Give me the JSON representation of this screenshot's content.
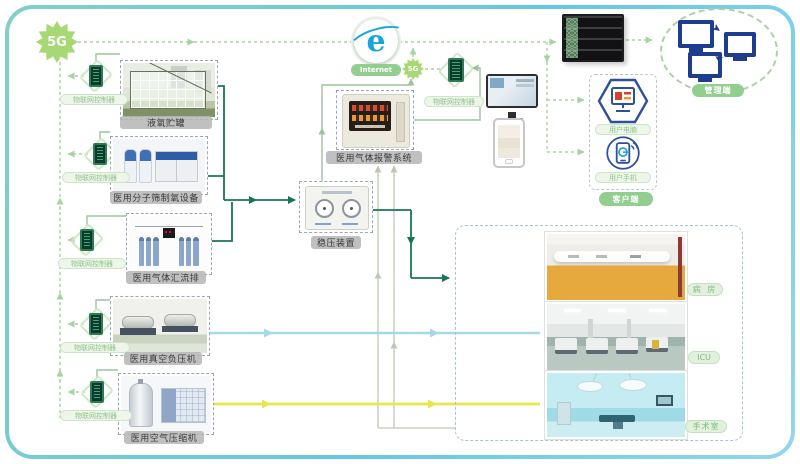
{
  "top": {
    "g5_main": "5G",
    "internet_label": "Internet",
    "g5_small": "5G",
    "gateway_label": "物联网控制器",
    "cloud_label": "管理端"
  },
  "client": {
    "pc_label": "用户电脑",
    "phone_label": "用户手机",
    "box_label": "客户端"
  },
  "center": {
    "alarm_label": "医用气体报警系统",
    "stabilizer_label": "稳压装置"
  },
  "devices": [
    {
      "controller": "物联网控制器",
      "name": "液氧贮罐"
    },
    {
      "controller": "物联网控制器",
      "name": "医用分子筛制氧设备"
    },
    {
      "controller": "物联网控制器",
      "name": "医用气体汇流排"
    },
    {
      "controller": "物联网控制器",
      "name": "医用真空负压机"
    },
    {
      "controller": "物联网控制器",
      "name": "医用空气压缩机"
    }
  ],
  "rooms": [
    {
      "name": "病 房"
    },
    {
      "name": "ICU"
    },
    {
      "name": "手术室"
    }
  ],
  "colors": {
    "frame": "#63c8e6",
    "dash_green": "#a9d3a4",
    "pipe_oxygen": "#17755a",
    "pipe_vacuum": "#a5d8ea",
    "pipe_air": "#e8e64a",
    "pill_green": "#92ce90",
    "ie_blue": "#18a4dc",
    "device_blue": "#2d4f9e"
  }
}
